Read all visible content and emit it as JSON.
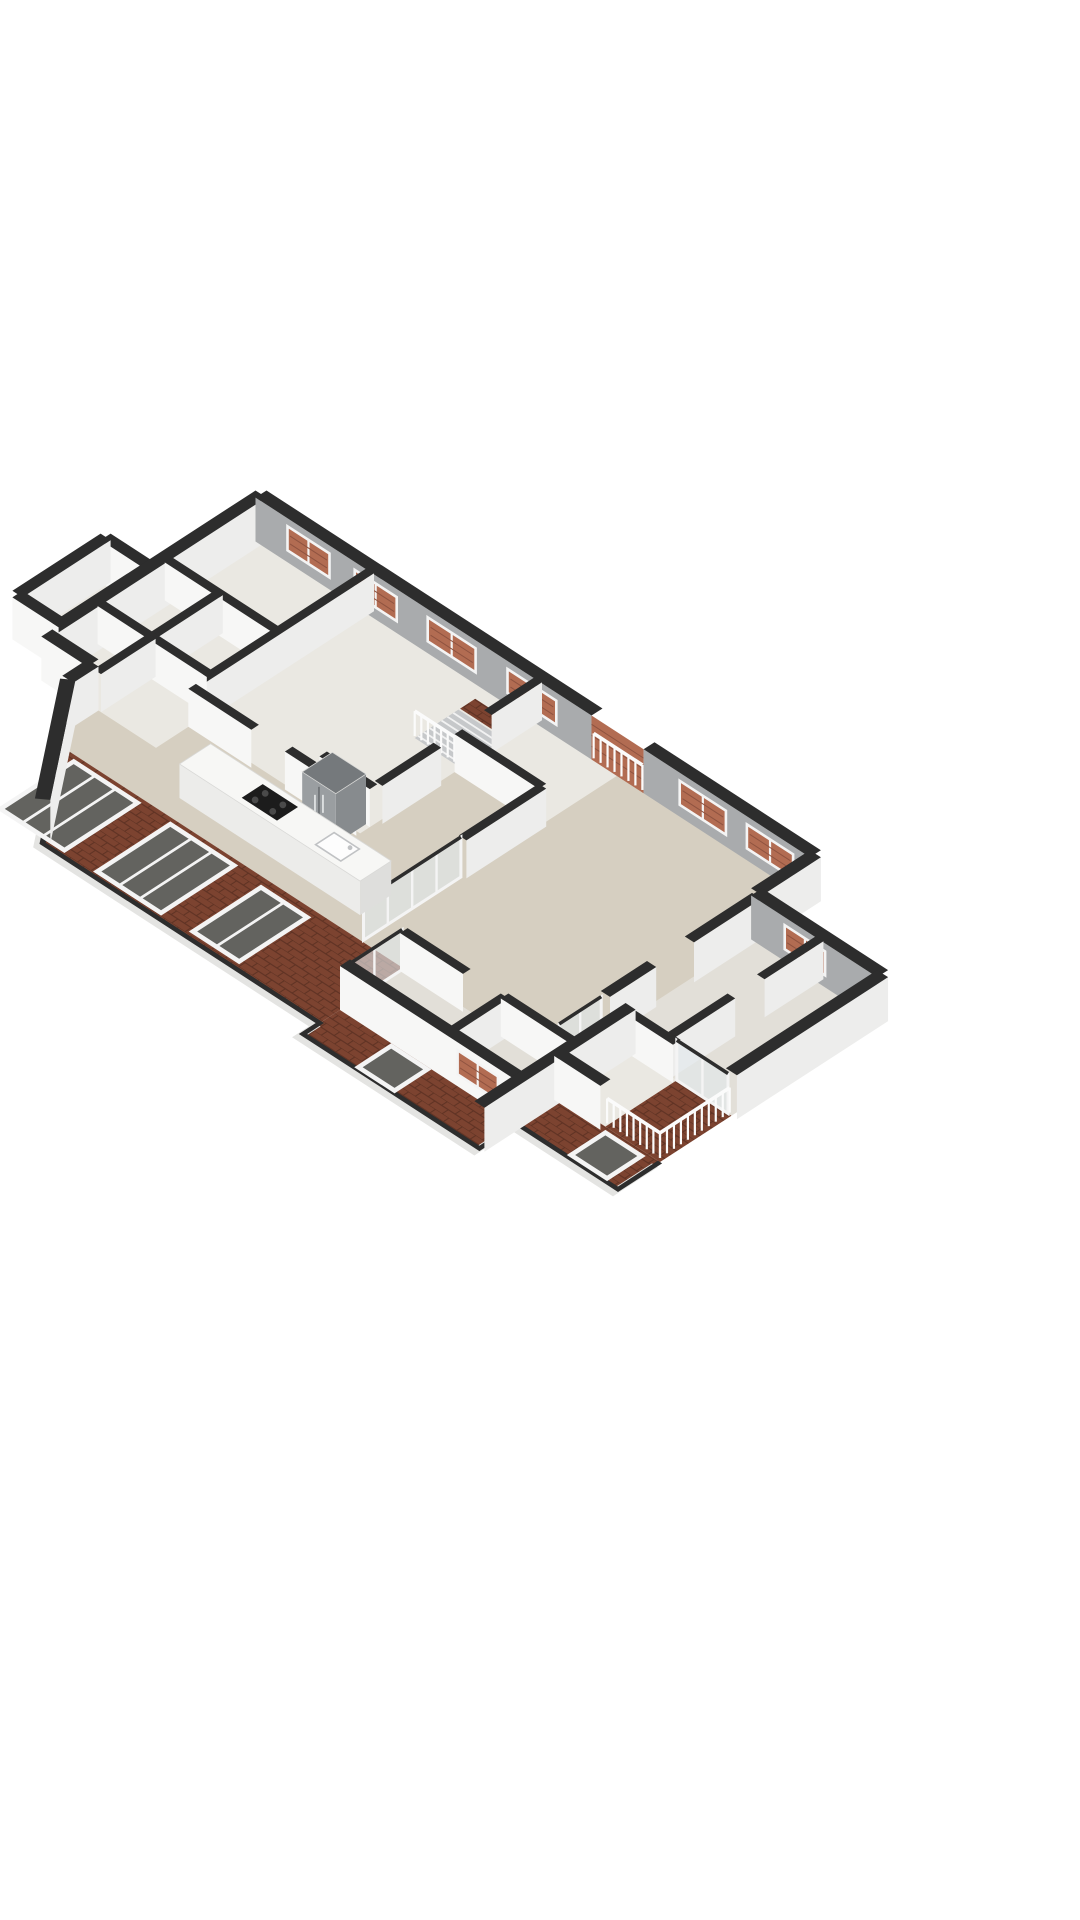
{
  "meta": {
    "type": "3d-floorplan-render",
    "title": "3D floor plan render (isometric, no text labels)",
    "background": "#ffffff"
  },
  "colors": {
    "cap": "#2d2d2d",
    "wallWhite": "#f7f7f6",
    "wallWhite2": "#ededec",
    "wallGray": "#a9abad",
    "floorPale": "#eae8e2",
    "floorPale2": "#e2dfd8",
    "floorBeige": "#d6cfc1",
    "roofBrick": "#7c4330",
    "roofBrickLine": "#5e3223",
    "windowBrick": "#b26c52",
    "windowBrickLine": "#8f5340",
    "glassDark": "#63635f",
    "glassPale": "#e2e9ec",
    "frameWhite": "#f4f4f4",
    "rail": "#fbfbfb",
    "fasciaWhite": "#e4e4e2",
    "stairBase": "#c6c8ca",
    "tread": "#f2f2f2",
    "islandTop": "#f7f7f5",
    "islandFront": "#ececea",
    "islandSide": "#dededc",
    "cooktop": "#1c1c1c",
    "burner": "#4a4a4a",
    "sink": "#fdfdfd",
    "sinkEdge": "#c0c2c4",
    "fridgeTop": "#75797c",
    "fridgeFront": "#9a9ea1",
    "fridgeSide": "#878b8e",
    "fridgeLine": "#6b6f72"
  },
  "projection": {
    "origin": [
      261,
      538
    ],
    "u": [
      0.84,
      0.545
    ],
    "v": [
      -0.84,
      0.545
    ]
  },
  "floors": [
    {
      "name": "base-floor",
      "color": "floorPale",
      "pts": [
        [
          0,
          0
        ],
        [
          660,
          0
        ],
        [
          660,
          70
        ],
        [
          810,
          70
        ],
        [
          810,
          250
        ],
        [
          810,
          335
        ],
        [
          690,
          335
        ],
        [
          690,
          430
        ],
        [
          480,
          430
        ],
        [
          480,
          410
        ],
        [
          150,
          410
        ],
        [
          55,
          285
        ],
        [
          55,
          255
        ],
        [
          0,
          255
        ]
      ]
    },
    {
      "name": "left-annex-floor",
      "color": "floorPale",
      "pts": [
        [
          -55,
          130
        ],
        [
          0,
          130
        ],
        [
          0,
          235
        ],
        [
          -55,
          235
        ]
      ]
    },
    {
      "name": "right-wing-floor",
      "color": "floorPale2",
      "pts": [
        [
          660,
          70
        ],
        [
          810,
          70
        ],
        [
          810,
          250
        ],
        [
          660,
          250
        ]
      ]
    },
    {
      "name": "living-kitchen-floor",
      "color": "floorBeige",
      "pts": [
        [
          430,
          0
        ],
        [
          660,
          0
        ],
        [
          660,
          310
        ],
        [
          74,
          310
        ],
        [
          55,
          285
        ],
        [
          55,
          255
        ],
        [
          130,
          255
        ],
        [
          130,
          212
        ],
        [
          330,
          212
        ],
        [
          330,
          95
        ],
        [
          430,
          95
        ]
      ]
    },
    {
      "name": "bottom-rooms-floor",
      "color": "floorPale2",
      "pts": [
        [
          480,
          310
        ],
        [
          690,
          310
        ],
        [
          690,
          380
        ],
        [
          480,
          380
        ]
      ]
    },
    {
      "name": "annex-room-floor",
      "color": "floorPale",
      "pts": [
        [
          690,
          250
        ],
        [
          745,
          250
        ],
        [
          745,
          335
        ],
        [
          690,
          335
        ]
      ]
    }
  ],
  "balconyFloor": {
    "name": "balcony-floor",
    "pts": [
      [
        745,
        250
      ],
      [
        810,
        250
      ],
      [
        810,
        335
      ],
      [
        745,
        335
      ]
    ]
  },
  "roofs": [
    {
      "name": "main-roof",
      "pts": [
        [
          74,
          310
        ],
        [
          480,
          310
        ],
        [
          480,
          410
        ],
        [
          150,
          410
        ],
        [
          55,
          285
        ]
      ]
    },
    {
      "name": "bottom-rooms-roof",
      "pts": [
        [
          480,
          380
        ],
        [
          690,
          380
        ],
        [
          690,
          430
        ],
        [
          480,
          430
        ]
      ]
    },
    {
      "name": "annex-roof",
      "pts": [
        [
          690,
          335
        ],
        [
          810,
          335
        ],
        [
          810,
          385
        ],
        [
          690,
          385
        ]
      ]
    }
  ],
  "eave": {
    "outer": [
      [
        55,
        285
      ],
      [
        150,
        410
      ],
      [
        480,
        410
      ],
      [
        480,
        430
      ],
      [
        690,
        430
      ],
      [
        690,
        385
      ],
      [
        810,
        385
      ],
      [
        810,
        335
      ]
    ]
  },
  "skylights": [
    {
      "x1": 95,
      "y1": 318,
      "x2": 168,
      "y2": 402,
      "panes": 3
    },
    {
      "x1": 210,
      "y1": 318,
      "x2": 283,
      "y2": 402,
      "panes": 3
    },
    {
      "x1": 322,
      "y1": 322,
      "x2": 374,
      "y2": 400,
      "panes": 2
    },
    {
      "x1": 545,
      "y1": 390,
      "x2": 585,
      "y2": 426,
      "panes": 1
    },
    {
      "x1": 752,
      "y1": 342,
      "x2": 792,
      "y2": 380,
      "panes": 1
    }
  ],
  "stair": {
    "base": [
      275,
      40,
      330,
      92
    ],
    "brick": [
      275,
      20,
      330,
      38
    ],
    "treadFrom": 46,
    "treadTo": 88,
    "treadStep": 7
  },
  "walls": [
    {
      "a": [
        0,
        0
      ],
      "b": [
        400,
        0
      ],
      "t": 13,
      "h": 44,
      "face": "g",
      "windows": [
        {
          "a": [
            38,
            0
          ],
          "b": [
            88,
            0
          ]
        },
        {
          "a": [
            118,
            0
          ],
          "b": [
            168,
            0
          ]
        },
        {
          "a": [
            205,
            0
          ],
          "b": [
            262,
            0
          ]
        },
        {
          "a": [
            300,
            0
          ],
          "b": [
            358,
            0
          ]
        }
      ]
    },
    {
      "a": [
        462,
        0
      ],
      "b": [
        660,
        0
      ],
      "t": 13,
      "h": 44,
      "face": "g",
      "windows": [
        {
          "a": [
            505,
            0
          ],
          "b": [
            560,
            0
          ]
        },
        {
          "a": [
            585,
            0
          ],
          "b": [
            640,
            0
          ]
        }
      ]
    },
    {
      "a": [
        0,
        0
      ],
      "b": [
        0,
        255
      ],
      "t": 13,
      "h": 44,
      "face": "w"
    },
    {
      "a": [
        0,
        255
      ],
      "b": [
        55,
        255
      ],
      "t": 13,
      "h": 44,
      "face": "w"
    },
    {
      "a": [
        55,
        255
      ],
      "b": [
        55,
        285
      ],
      "t": 13,
      "h": 44,
      "face": "w"
    },
    {
      "a": [
        55,
        285
      ],
      "b": [
        150,
        410
      ],
      "t": 13,
      "h": 44,
      "face": "w"
    },
    {
      "a": [
        660,
        0
      ],
      "b": [
        660,
        70
      ],
      "t": 13,
      "h": 44,
      "face": "w"
    },
    {
      "a": [
        660,
        70
      ],
      "b": [
        810,
        70
      ],
      "t": 13,
      "h": 44,
      "face": "g",
      "windows": [
        {
          "a": [
            700,
            70
          ],
          "b": [
            748,
            70
          ]
        }
      ]
    },
    {
      "a": [
        810,
        70
      ],
      "b": [
        810,
        250
      ],
      "t": 13,
      "h": 44,
      "face": "w"
    },
    {
      "a": [
        690,
        335
      ],
      "b": [
        745,
        335
      ],
      "t": 12,
      "h": 44,
      "face": "w"
    },
    {
      "a": [
        690,
        250
      ],
      "b": [
        690,
        430
      ],
      "t": 12,
      "h": 44,
      "face": "w"
    },
    {
      "a": [
        480,
        380
      ],
      "b": [
        690,
        380
      ],
      "t": 12,
      "h": 44,
      "face": "w",
      "windows": [
        {
          "a": [
            620,
            380
          ],
          "b": [
            668,
            380
          ]
        }
      ]
    },
    {
      "a": [
        -55,
        130
      ],
      "b": [
        0,
        130
      ],
      "t": 12,
      "h": 42,
      "face": "w"
    },
    {
      "a": [
        -55,
        130
      ],
      "b": [
        -55,
        235
      ],
      "t": 12,
      "h": 42,
      "face": "w"
    },
    {
      "a": [
        -55,
        235
      ],
      "b": [
        0,
        235
      ],
      "t": 12,
      "h": 42,
      "face": "w"
    },
    {
      "a": [
        130,
        0
      ],
      "b": [
        130,
        212
      ],
      "t": 9,
      "h": 38,
      "face": "w"
    },
    {
      "a": [
        0,
        110
      ],
      "b": [
        130,
        110
      ],
      "t": 9,
      "h": 38,
      "face": "w"
    },
    {
      "a": [
        0,
        190
      ],
      "b": [
        130,
        190
      ],
      "t": 9,
      "h": 38,
      "face": "w"
    },
    {
      "a": [
        60,
        110
      ],
      "b": [
        60,
        190
      ],
      "t": 9,
      "h": 38,
      "face": "w"
    },
    {
      "a": [
        60,
        190
      ],
      "b": [
        60,
        255
      ],
      "t": 9,
      "h": 38,
      "face": "w"
    },
    {
      "a": [
        330,
        0
      ],
      "b": [
        330,
        60
      ],
      "t": 9,
      "h": 38,
      "face": "w"
    },
    {
      "a": [
        330,
        120
      ],
      "b": [
        330,
        190
      ],
      "t": 9,
      "h": 38,
      "face": "w"
    },
    {
      "a": [
        330,
        95
      ],
      "b": [
        430,
        95
      ],
      "t": 9,
      "h": 38,
      "face": "w"
    },
    {
      "a": [
        430,
        95
      ],
      "b": [
        430,
        190
      ],
      "t": 9,
      "h": 38,
      "face": "w"
    },
    {
      "a": [
        130,
        212
      ],
      "b": [
        205,
        212
      ],
      "t": 9,
      "h": 38,
      "face": "w"
    },
    {
      "a": [
        245,
        212
      ],
      "b": [
        330,
        212
      ],
      "t": 9,
      "h": 38,
      "face": "w"
    },
    {
      "a": [
        270,
        196
      ],
      "b": [
        330,
        196
      ],
      "t": 9,
      "h": 38,
      "face": "w"
    },
    {
      "a": [
        480,
        310
      ],
      "b": [
        555,
        310
      ],
      "t": 9,
      "h": 38,
      "face": "w"
    },
    {
      "a": [
        600,
        310
      ],
      "b": [
        690,
        310
      ],
      "t": 9,
      "h": 38,
      "face": "w"
    },
    {
      "a": [
        600,
        310
      ],
      "b": [
        600,
        380
      ],
      "t": 9,
      "h": 38,
      "face": "w"
    },
    {
      "a": [
        735,
        70
      ],
      "b": [
        735,
        140
      ],
      "t": 9,
      "h": 38,
      "face": "w"
    },
    {
      "a": [
        735,
        175
      ],
      "b": [
        735,
        250
      ],
      "t": 9,
      "h": 38,
      "face": "w"
    },
    {
      "a": [
        660,
        70
      ],
      "b": [
        660,
        150
      ],
      "t": 11,
      "h": 40,
      "face": "w"
    },
    {
      "a": [
        660,
        195
      ],
      "b": [
        660,
        250
      ],
      "t": 11,
      "h": 40,
      "face": "w"
    },
    {
      "a": [
        690,
        250
      ],
      "b": [
        745,
        250
      ],
      "t": 9,
      "h": 38,
      "face": "w"
    }
  ],
  "panels": [
    {
      "a": [
        400,
        0
      ],
      "b": [
        462,
        0
      ],
      "t": 13,
      "h": 44
    }
  ],
  "railings": [
    {
      "a": [
        402,
        6
      ],
      "b": [
        460,
        6
      ]
    },
    {
      "a": [
        275,
        92
      ],
      "b": [
        330,
        92
      ]
    },
    {
      "a": [
        745,
        333
      ],
      "b": [
        808,
        333
      ]
    },
    {
      "a": [
        808,
        250
      ],
      "b": [
        808,
        333
      ]
    }
  ],
  "glassWalls": [
    {
      "a": [
        430,
        192
      ],
      "b": [
        430,
        308
      ],
      "h": 40,
      "panes": 4
    },
    {
      "a": [
        480,
        312
      ],
      "b": [
        480,
        378
      ],
      "h": 40,
      "panes": 2
    },
    {
      "a": [
        745,
        250
      ],
      "b": [
        806,
        250
      ],
      "h": 40,
      "panes": 2
    },
    {
      "a": [
        660,
        255
      ],
      "b": [
        660,
        305
      ],
      "h": 40,
      "panes": 2
    }
  ],
  "island": {
    "rect": [
      190,
      250,
      405,
      287
    ],
    "h": 34,
    "cooktop": [
      258,
      256,
      300,
      281
    ],
    "burners": [
      [
        268,
        263
      ],
      [
        289,
        263
      ],
      [
        268,
        275
      ],
      [
        289,
        275
      ]
    ],
    "sink": [
      345,
      258,
      375,
      280
    ],
    "faucet": [
      372,
      266
    ]
  },
  "fridge": {
    "rect": [
      285,
      200,
      325,
      236
    ],
    "h": 50
  }
}
